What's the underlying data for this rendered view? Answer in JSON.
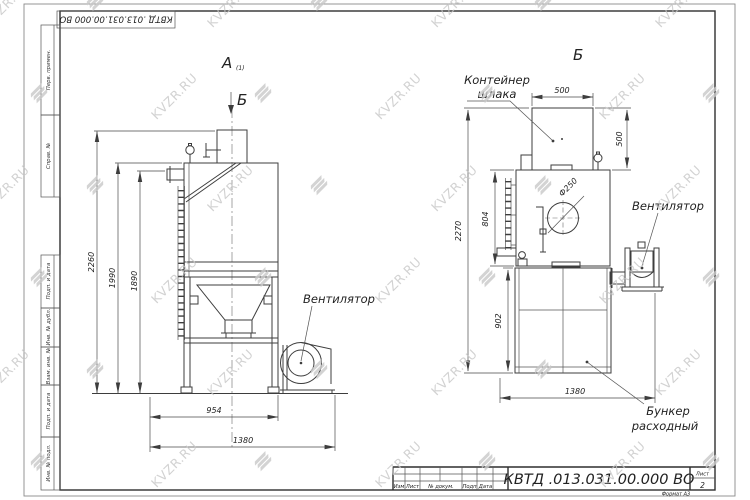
{
  "watermark": {
    "text": "KVZR.RU"
  },
  "colors": {
    "ink": "#3d3d3d",
    "watermark": "#c9c9c9",
    "paper": "#ffffff"
  },
  "frame": {
    "top_stamp": "КВТД .013.031.00.000  ВО",
    "side_stamp": [
      "Перв. примен.",
      "Справ. №",
      "Подп. и дата",
      "Инв. № дубл.",
      "Взам. инв. №",
      "Подп. и дата",
      "Инв. № подл."
    ]
  },
  "views": {
    "left": {
      "label": "А",
      "label_sub": "(1)",
      "section_mark": "Б",
      "fan_label": "Вентилятор",
      "dims": {
        "d2260": "2260",
        "d1990": "1990",
        "d1890": "1890",
        "d954": "954",
        "d1380": "1380"
      }
    },
    "right": {
      "label": "Б",
      "container_line1": "Контейнер",
      "container_line2": "шлака",
      "fan_label": "Вентилятор",
      "hopper_line1": "Бункер",
      "hopper_line2": "расходный",
      "diameter": "Ф250",
      "dims": {
        "top500": "500",
        "right500": "500",
        "d2270": "2270",
        "d804": "804",
        "d902": "902",
        "d1380": "1380"
      }
    }
  },
  "title_block": {
    "doc_number": "КВТД .013.031.00.000  ВО",
    "cols": [
      "Изм",
      "Лист",
      "№ докум.",
      "Подп",
      "Дата"
    ],
    "sheet_label": "Лист",
    "sheet_number": "2",
    "format_note": "Формат А3"
  }
}
